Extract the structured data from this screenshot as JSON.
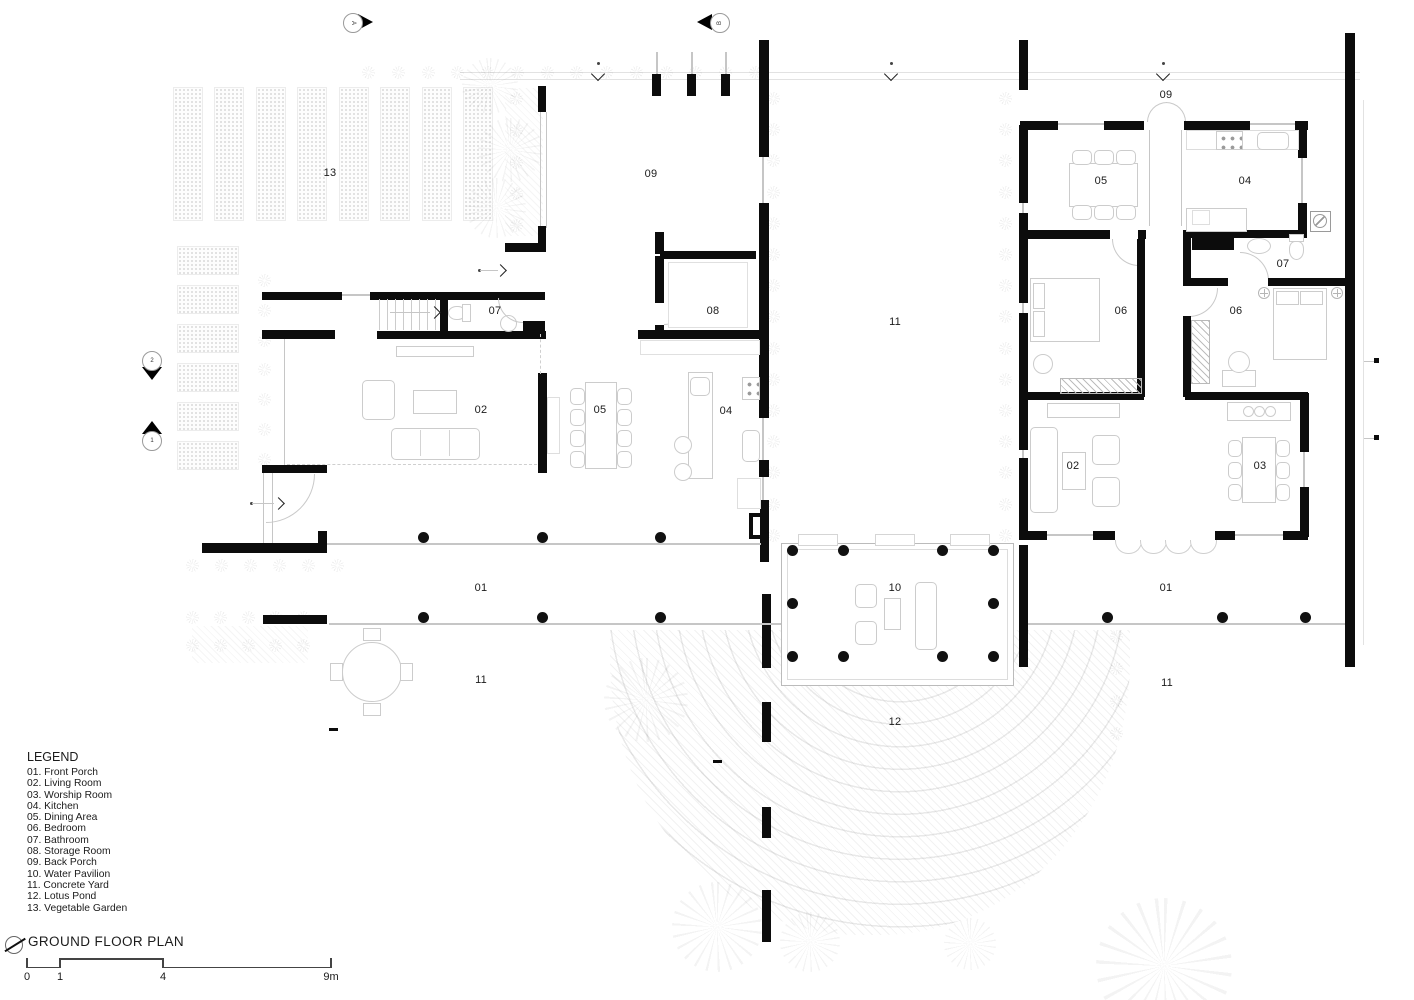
{
  "plan": {
    "rooms": {
      "garden": "13",
      "back_porch_left": "09",
      "back_porch_right": "09",
      "bath_left": "07",
      "storage": "08",
      "yard_center": "11",
      "dining_right": "05",
      "kitchen_right": "04",
      "bath_right": "07",
      "bedroom_right_a": "06",
      "bedroom_right_b": "06",
      "living_left": "02",
      "dining_left": "05",
      "kitchen_left": "04",
      "living_right": "02",
      "worship": "03",
      "porch_left": "01",
      "porch_right": "01",
      "pavilion": "10",
      "yard_left": "11",
      "yard_right": "11",
      "pond": "12"
    },
    "markers": {
      "section_a": "A",
      "section_b": "B",
      "left_upper": "2",
      "left_lower": "1"
    }
  },
  "legend": {
    "title": "LEGEND",
    "items": [
      "01. Front Porch",
      "02. Living Room",
      "03. Worship Room",
      "04. Kitchen",
      "05. Dining Area",
      "06. Bedroom",
      "07. Bathroom",
      "08. Storage Room",
      "09. Back Porch",
      "10. Water Pavilion",
      "11. Concrete Yard",
      "12. Lotus Pond",
      "13. Vegetable Garden"
    ]
  },
  "title_block": {
    "title": "GROUND FLOOR PLAN"
  },
  "scale_bar": {
    "t0": "0",
    "t1": "1",
    "t4": "4",
    "t9": "9m"
  }
}
